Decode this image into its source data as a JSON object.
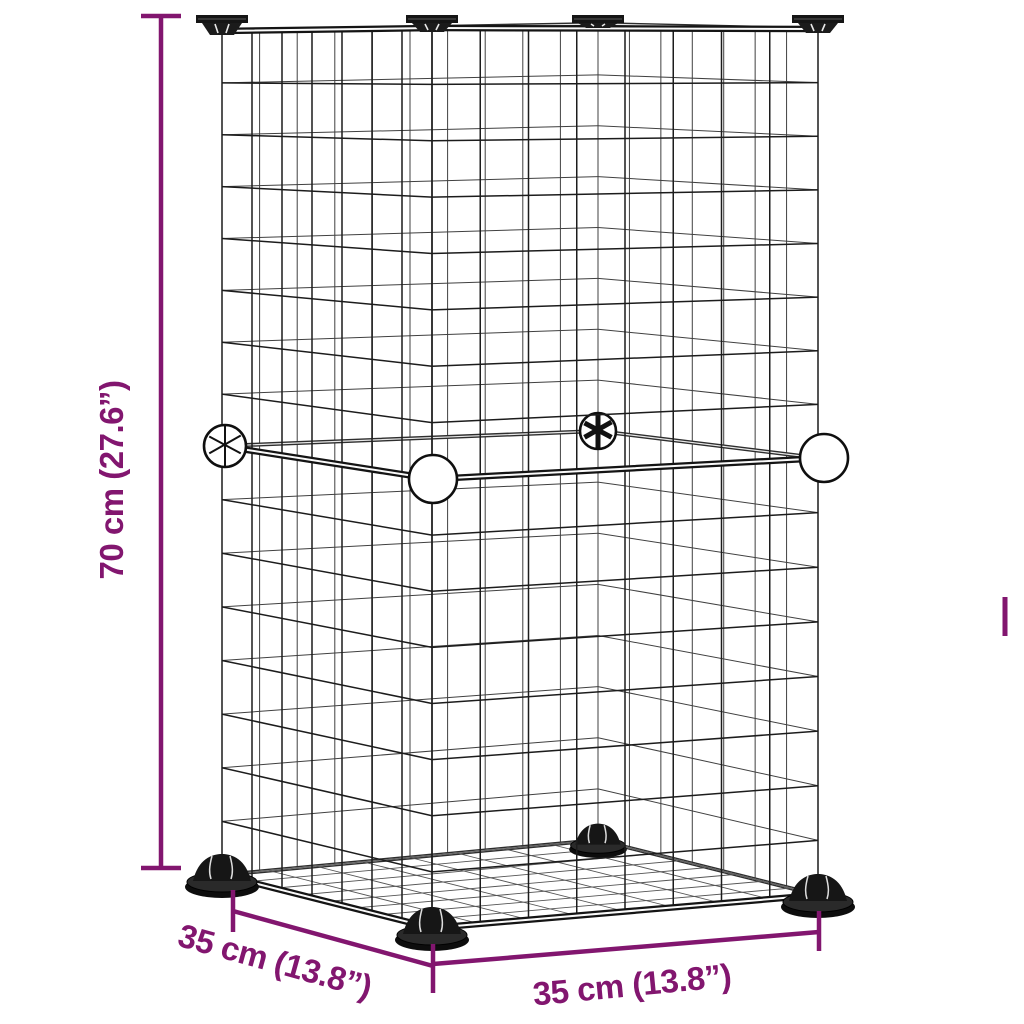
{
  "page": {
    "background": "#ffffff",
    "alt": "Line drawing of a two-tier wire grid small-animal cage with black corner connectors, white ball joints, black feet and purple dimension lines"
  },
  "colors": {
    "dimension": "#82166F",
    "wire": "#1c1c1c",
    "connector_black": "#151515",
    "ball_white": "#ffffff"
  },
  "annotations": {
    "height_label": "70 cm (27.6”)",
    "depth_label": "35 cm (13.8”)",
    "width_label": "35 cm (13.8”)"
  }
}
